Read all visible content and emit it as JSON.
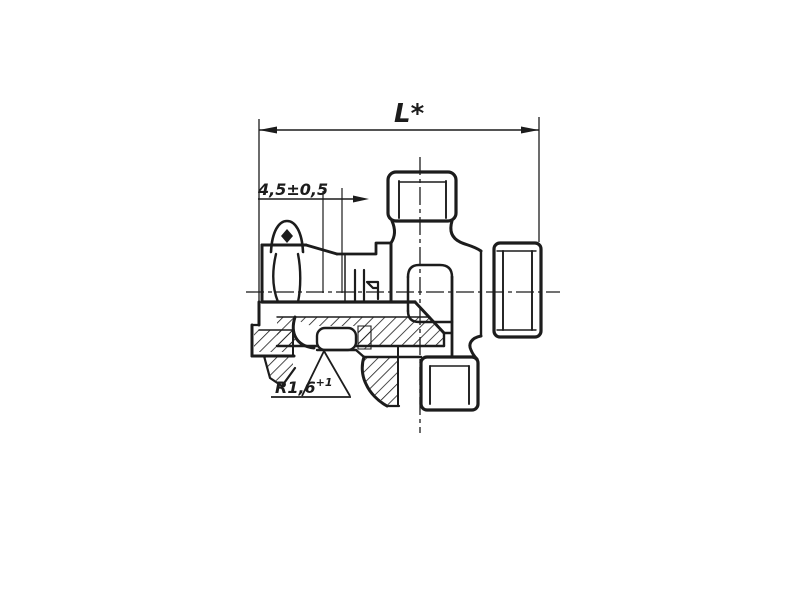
{
  "page": {
    "background": "#ffffff",
    "ink": "#1c1c1c"
  },
  "drawing": {
    "kind": "sectioned cross fitting with swivel nut",
    "labels": {
      "length_dim": "L*",
      "offset_dim": "4,5±0,5",
      "radius_dim": "R1,6",
      "radius_dim_sup": "+1"
    }
  }
}
